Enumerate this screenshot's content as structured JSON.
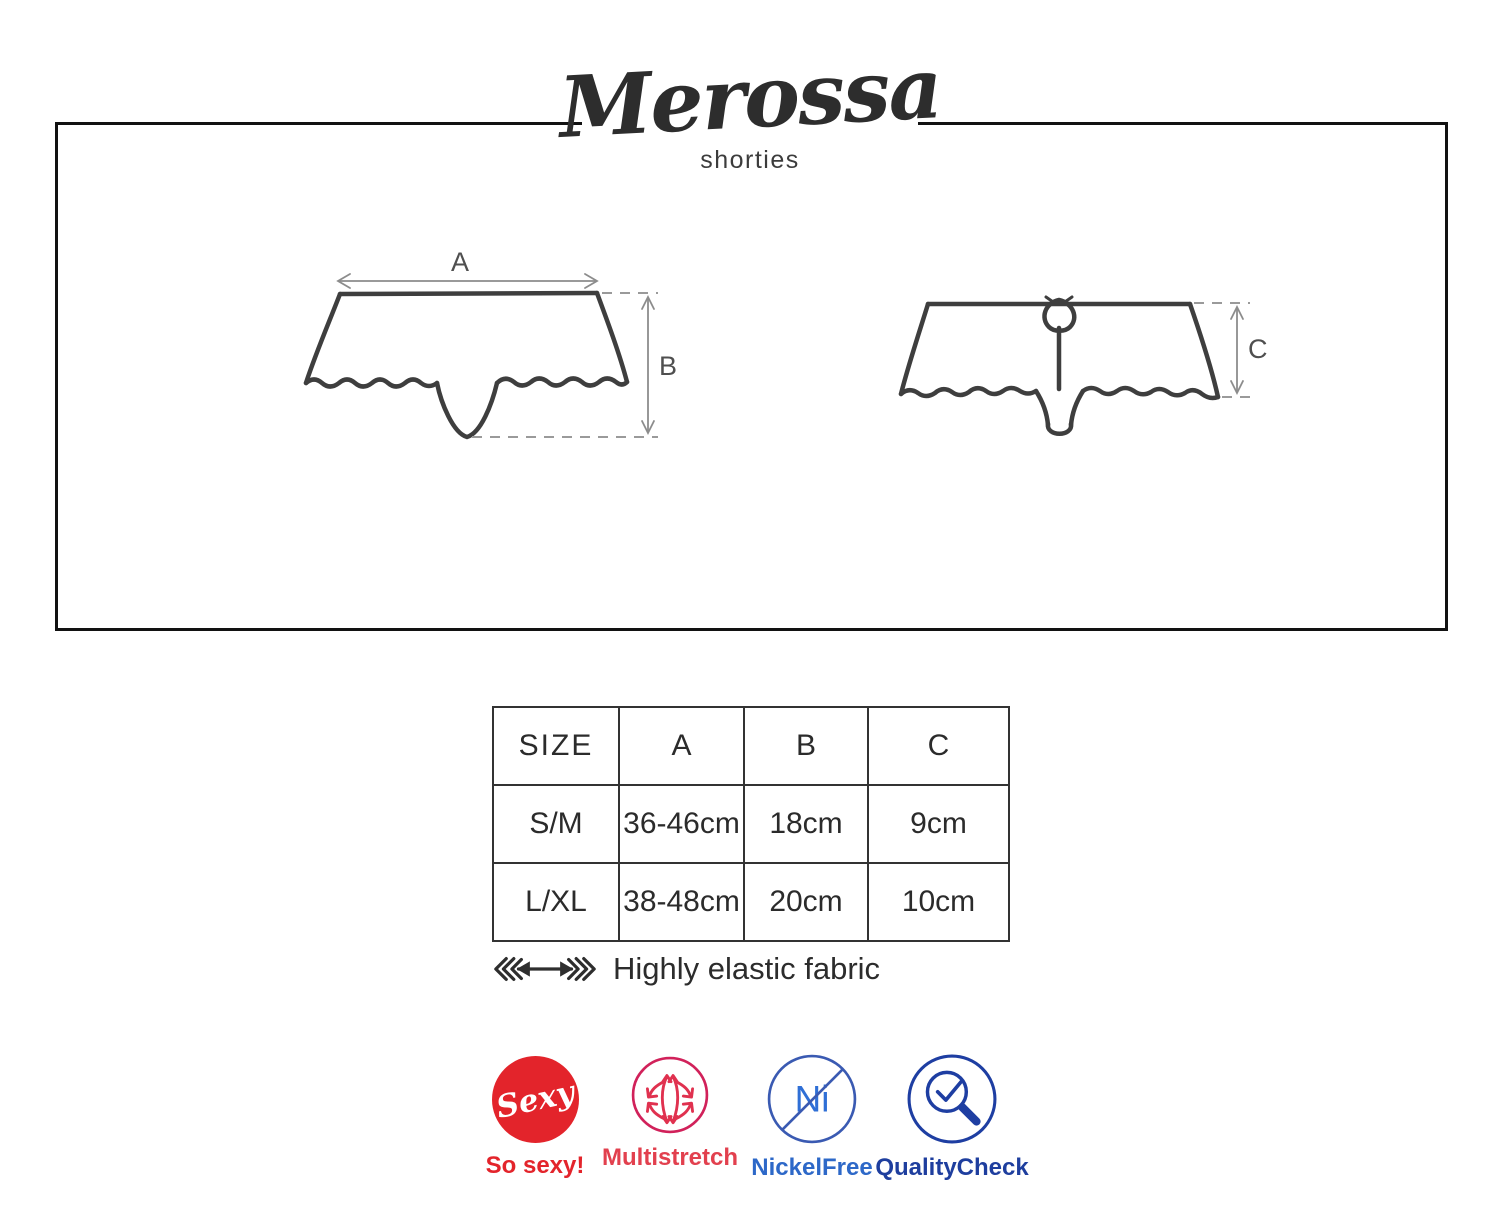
{
  "brand": {
    "name": "Merossa",
    "subtitle": "shorties"
  },
  "diagram": {
    "labels": {
      "a": "A",
      "b": "B",
      "c": "C"
    },
    "views": [
      "front-shorties-outline",
      "back-shorties-outline-with-bow-and-thong"
    ]
  },
  "table": {
    "headers": [
      "SIZE",
      "A",
      "B",
      "C"
    ],
    "rows": [
      [
        "S/M",
        "36-46cm",
        "18cm",
        "9cm"
      ],
      [
        "L/XL",
        "38-48cm",
        "20cm",
        "10cm"
      ]
    ]
  },
  "features": {
    "elastic_label": "Highly elastic fabric"
  },
  "badges": [
    {
      "name": "so-sexy",
      "circle_text": "Sexy",
      "label": "So sexy!",
      "color": "#e3242b"
    },
    {
      "name": "multistretch",
      "label": "Multistretch",
      "color": "#e2404e",
      "icon_color": "#d1215a"
    },
    {
      "name": "nickel-free",
      "circle_text": "Ni",
      "label": "NickelFree",
      "color": "#2d68c8",
      "icon_color": "#3a5ab2"
    },
    {
      "name": "quality-check",
      "label": "QualityCheck",
      "color": "#1e3e9e",
      "icon_color": "#1e3ea2"
    }
  ],
  "colors": {
    "frame_border": "#121212",
    "garment_stroke": "#3e3e3e",
    "dimension_stroke": "#8c8c8c",
    "table_border": "#333333"
  }
}
